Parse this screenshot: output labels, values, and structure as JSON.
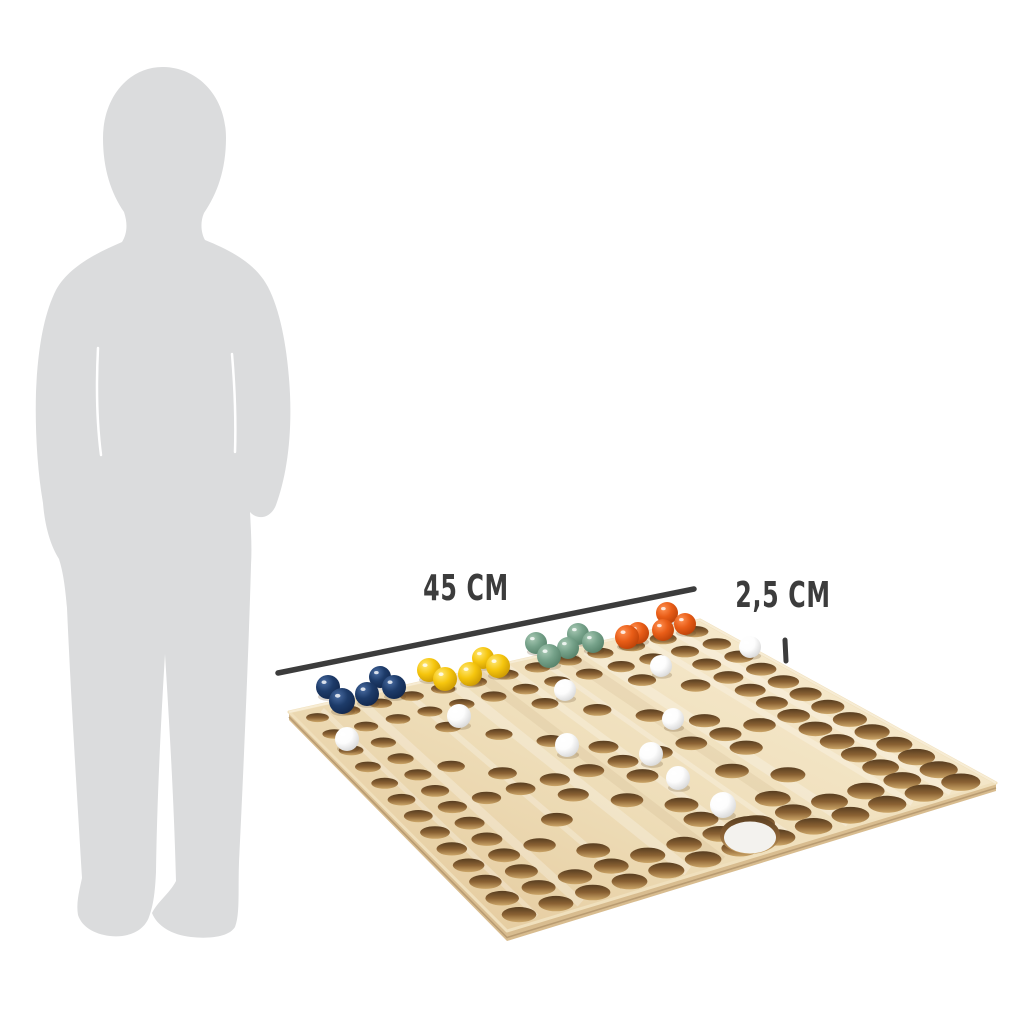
{
  "photo": {
    "background": "#ffffff",
    "subject": "wooden barricade marble game board with child silhouette for scale"
  },
  "dimensions": {
    "board_width": {
      "label": "45 cm"
    },
    "hole_diameter": {
      "label": "2,5 cm"
    },
    "color": "#3c3c3c",
    "width_line": {
      "x1": 278,
      "y1": 673,
      "x2": 694,
      "y2": 589
    },
    "tick": {
      "x1": 785,
      "y1": 640,
      "x2": 786,
      "y2": 661
    }
  },
  "silhouette": {
    "label": "child silhouette",
    "color": "#dbdcdd"
  },
  "board": {
    "colors": {
      "face_light": "#f6e9cc",
      "face_mid": "#eeddb8",
      "face_dark": "#e6cda1",
      "edge": "#d8bc8f",
      "edge_line": "#b2936a",
      "chamfer": "#f9efd9",
      "hole_dark": "#573d20",
      "hole_mid": "#8a6133",
      "hole_light": "#cda769",
      "big_hole_fill": "#f3f2ee"
    },
    "corners": {
      "left": [
        289,
        712
      ],
      "back": [
        700,
        620
      ],
      "right": [
        996,
        783
      ],
      "front": [
        507,
        931
      ]
    },
    "grid_rows": [
      "1111111111111",
      "1111111111111",
      "1101001001011",
      "1100100100111",
      "1110010010011",
      "1101001001011",
      "1111111111111",
      "1100101001011",
      "1101010010011",
      "1110001001011",
      "1101001010011",
      "1111111111111",
      "1111111111111"
    ],
    "big_hole": {
      "cx": 750,
      "cy": 835,
      "rx": 26,
      "ry": 16
    }
  },
  "balls": {
    "groups": [
      {
        "name": "navy-blue",
        "hex": "#1d3b69",
        "light": "#4a6da3",
        "dark": "#0f2347",
        "count": 5,
        "positions": [
          [
            328,
            687,
            12
          ],
          [
            342,
            701,
            13
          ],
          [
            367,
            694,
            12
          ],
          [
            380,
            677,
            11
          ],
          [
            394,
            687,
            12
          ]
        ]
      },
      {
        "name": "yellow",
        "hex": "#f6c60e",
        "light": "#ffe876",
        "dark": "#c28f00",
        "count": 5,
        "positions": [
          [
            429,
            670,
            12
          ],
          [
            445,
            679,
            12
          ],
          [
            470,
            674,
            12
          ],
          [
            483,
            658,
            11
          ],
          [
            498,
            666,
            12
          ]
        ]
      },
      {
        "name": "sage-green",
        "hex": "#76a28a",
        "light": "#a8c9b4",
        "dark": "#4f7a62",
        "count": 5,
        "positions": [
          [
            536,
            643,
            11
          ],
          [
            549,
            656,
            12
          ],
          [
            568,
            648,
            11
          ],
          [
            578,
            634,
            11
          ],
          [
            593,
            642,
            11
          ]
        ]
      },
      {
        "name": "orange",
        "hex": "#e95d17",
        "light": "#ff9152",
        "dark": "#b23c05",
        "count": 5,
        "positions": [
          [
            627,
            637,
            12
          ],
          [
            638,
            633,
            11
          ],
          [
            663,
            630,
            11
          ],
          [
            667,
            613,
            11
          ],
          [
            685,
            624,
            11
          ]
        ]
      },
      {
        "name": "white",
        "hex": "#fdfdfd",
        "light": "#ffffff",
        "dark": "#cfcfcf",
        "count": 10,
        "positions": [
          [
            347,
            739,
            12
          ],
          [
            459,
            716,
            12
          ],
          [
            565,
            690,
            11
          ],
          [
            661,
            666,
            11
          ],
          [
            673,
            719,
            11
          ],
          [
            567,
            745,
            12
          ],
          [
            651,
            754,
            12
          ],
          [
            678,
            778,
            12
          ],
          [
            723,
            805,
            13
          ],
          [
            750,
            647,
            11
          ]
        ]
      }
    ]
  }
}
